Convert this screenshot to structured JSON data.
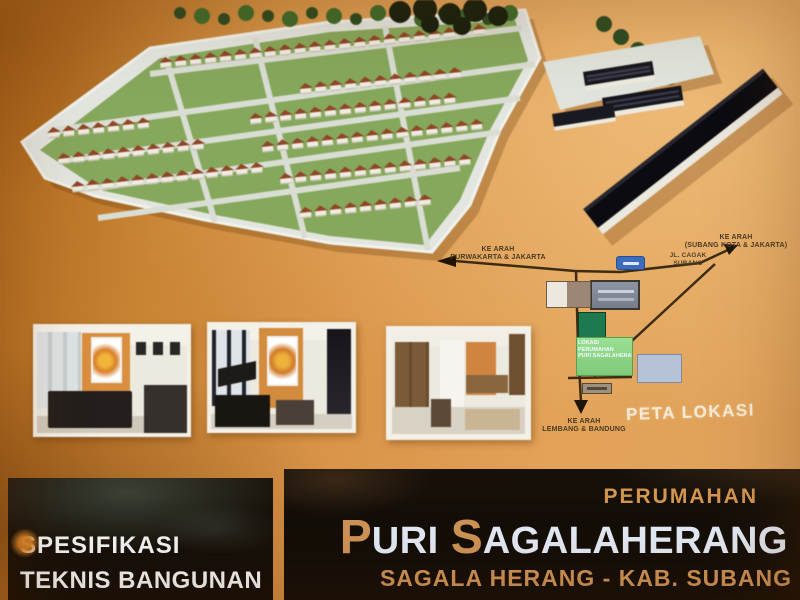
{
  "map": {
    "title": "PETA LOKASI",
    "label_west_line1": "KE ARAH",
    "label_west_line2": "PURWAKARTA & JAKARTA",
    "label_east_line1": "KE ARAH",
    "label_east_line2": "(SUBANG KOTA & JAKARTA)",
    "label_south_line1": "KE ARAH",
    "label_south_line2": "LEMBANG & BANDUNG",
    "label_junction_line1": "JL. CAGAK",
    "label_junction_line2": "SUBANG",
    "location_box_line1": "LOKASI",
    "location_box_line2": "PERUMAHAN",
    "location_box_line3": "PURI SAGALAHERANG"
  },
  "footer_left": {
    "line1": "SPESIFIKASI",
    "line2": "TEKNIS BANGUNAN"
  },
  "footer_right": {
    "kicker": "PERUMAHAN",
    "name_initial_1": "P",
    "name_part_1": "URI",
    "name_initial_2": "S",
    "name_part_2": "AGALAHERANG",
    "subtitle": "SAGALA HERANG - KAB. SUBANG"
  },
  "colors": {
    "background_orange": "#d9954e",
    "panel_black": "#15100a",
    "accent_text_orange": "#cd9356",
    "headline_white": "#e3eaf6",
    "map_road_brown": "#3e2c12",
    "location_box_green": "#8fd98a",
    "road_sign_blue": "#3b6cc0"
  }
}
